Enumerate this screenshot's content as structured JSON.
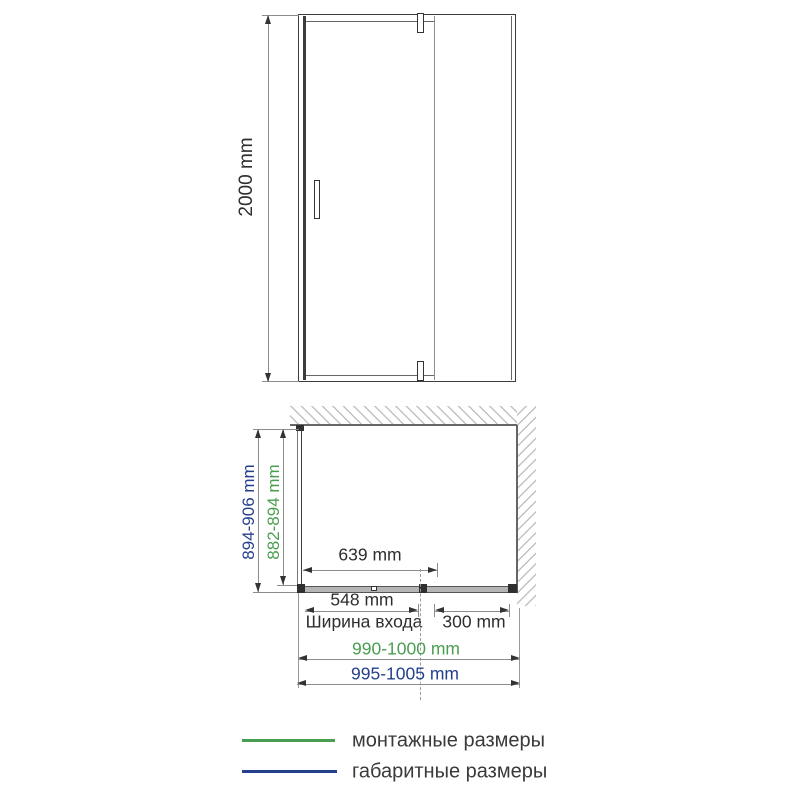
{
  "front_view": {
    "height_label": "2000 mm"
  },
  "plan_view": {
    "overall_depth_label": "894-906 mm",
    "mounting_depth_label": "882-894 mm",
    "door_width_label": "639 mm",
    "entrance_width_label": "548 mm",
    "entrance_caption": "Ширина входа",
    "fixed_panel_label": "300 mm",
    "mounting_width_label": "990-1000 mm",
    "overall_width_label": "995-1005 mm"
  },
  "legend": {
    "items": [
      {
        "label": "монтажные размеры",
        "color": "#4a9e50"
      },
      {
        "label": "габаритные размеры",
        "color": "#24408c"
      }
    ]
  },
  "colors": {
    "mounting_green": "#4a9e50",
    "overall_navy": "#24408c",
    "line_gray": "#8c8c8c",
    "drawing_dark": "#3d3d3d"
  }
}
